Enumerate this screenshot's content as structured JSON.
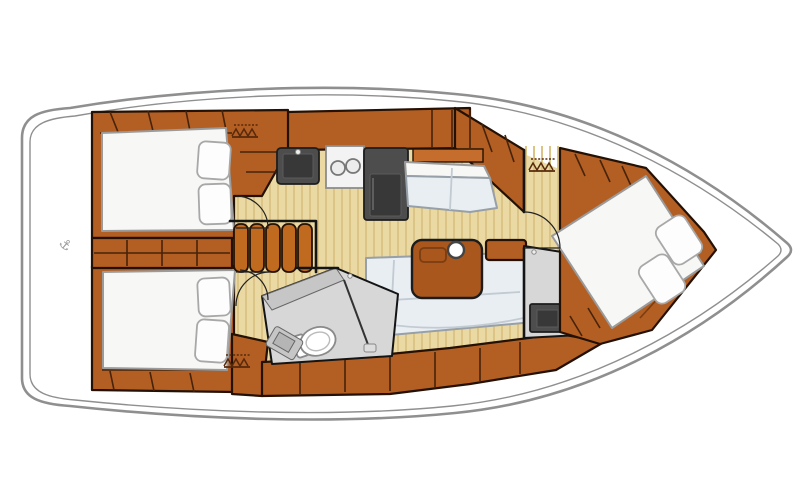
{
  "meta": {
    "description": "Overhead interior layout plan of a sailing yacht",
    "bow_direction": "right",
    "stern_direction": "left"
  },
  "symbols": {
    "anchor_glyph": "⚓",
    "dimension_hatches": 3
  },
  "layout": {
    "cabins": [
      {
        "name": "aft cabin port",
        "berth": "double",
        "pillows": 2
      },
      {
        "name": "aft cabin starboard",
        "berth": "double",
        "pillows": 2
      },
      {
        "name": "forward cabin",
        "berth": "angled island double",
        "pillows": 2
      }
    ],
    "heads": [
      {
        "name": "midship head",
        "fixtures": [
          "toilet",
          "vanity sink",
          "shower"
        ]
      },
      {
        "name": "forward head",
        "fixtures": [
          "toilet",
          "vanity sink"
        ]
      }
    ],
    "galley": {
      "appliances": [
        "sink",
        "two-burner stove",
        "refrigerator"
      ]
    },
    "salon": {
      "furniture": [
        "L-shaped settee",
        "table with mast post",
        "chaise settee"
      ]
    },
    "companionway": {
      "steps": 5
    }
  },
  "colors": {
    "hull_gray": "#8f8f8f",
    "wood": "#b35e22",
    "wood_light": "#c9света",
    "steps": "#bf6a1e",
    "floor": "#ead9a2",
    "floor_stripe": "#dcc486",
    "white_fixture": "#f7f7f6",
    "cushion": "#e9eef3",
    "appliance": "#4d4d4d",
    "appliance_inner": "#383838",
    "bath_floor": "#d7d7d7",
    "bath_counter": "#c6c6c6",
    "hatch_brown": "#57290b",
    "anchor_gray": "#9a9a9a",
    "table_wood": "#a9571c"
  }
}
